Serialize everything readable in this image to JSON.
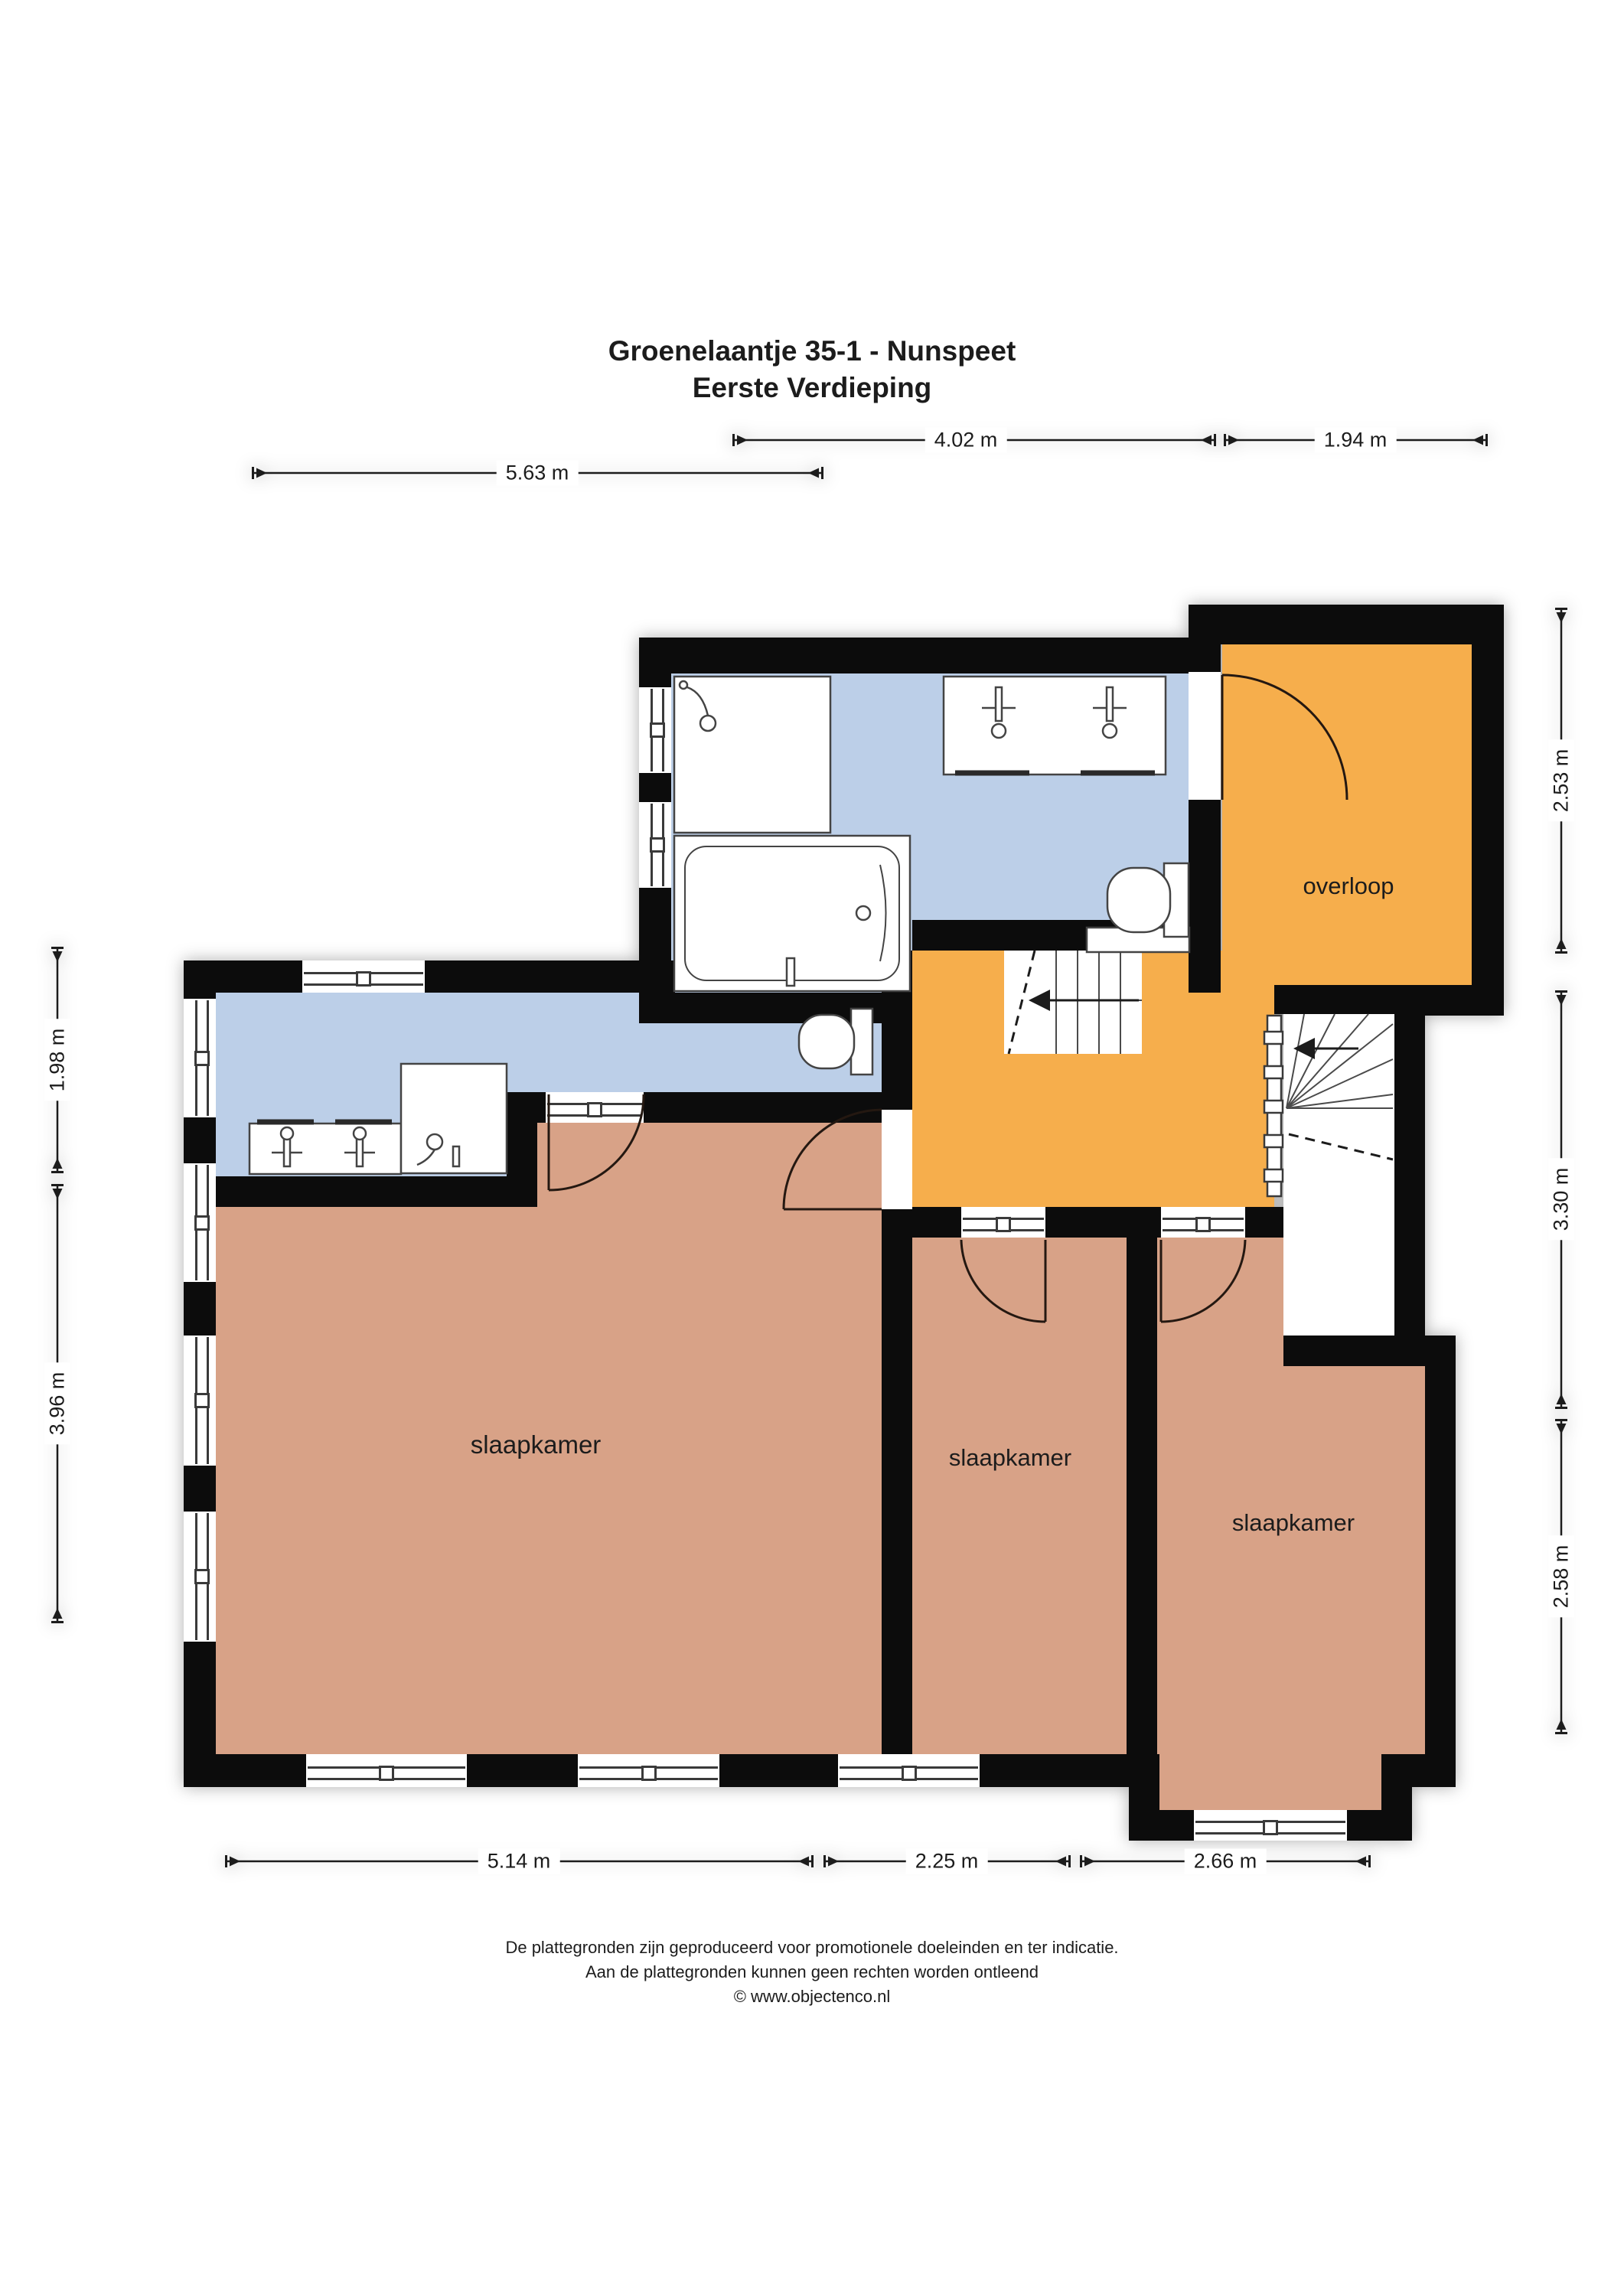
{
  "title": {
    "line1": "Groenelaantje 35-1 - Nunspeet",
    "line2": "Eerste Verdieping"
  },
  "rooms": {
    "overloop": {
      "label": "overloop"
    },
    "bedroom_left": {
      "label": "slaapkamer"
    },
    "bedroom_middle": {
      "label": "slaapkamer"
    },
    "bedroom_right": {
      "label": "slaapkamer"
    }
  },
  "dimensions": {
    "top_bathroom_width": "4.02 m",
    "top_overloop_width": "1.94 m",
    "top_left_width": "5.63 m",
    "right_top": "2.53 m",
    "right_middle": "3.30 m",
    "right_bottom": "2.58 m",
    "left_top": "1.98 m",
    "left_bottom": "3.96 m",
    "bottom_left": "5.14 m",
    "bottom_middle": "2.25 m",
    "bottom_right": "2.66 m"
  },
  "footer": {
    "line1": "De plattegronden zijn geproduceerd voor promotionele doeleinden en ter indicatie.",
    "line2": "Aan de plattegronden kunnen geen rechten worden ontleend",
    "line3": "© www.objectenco.nl"
  },
  "colors": {
    "wall": "#0c0c0c",
    "bathroom": "#bccfe8",
    "hallway": "#f6ae4c",
    "bedroom": "#d8a287",
    "line": "#2a2a2a"
  }
}
